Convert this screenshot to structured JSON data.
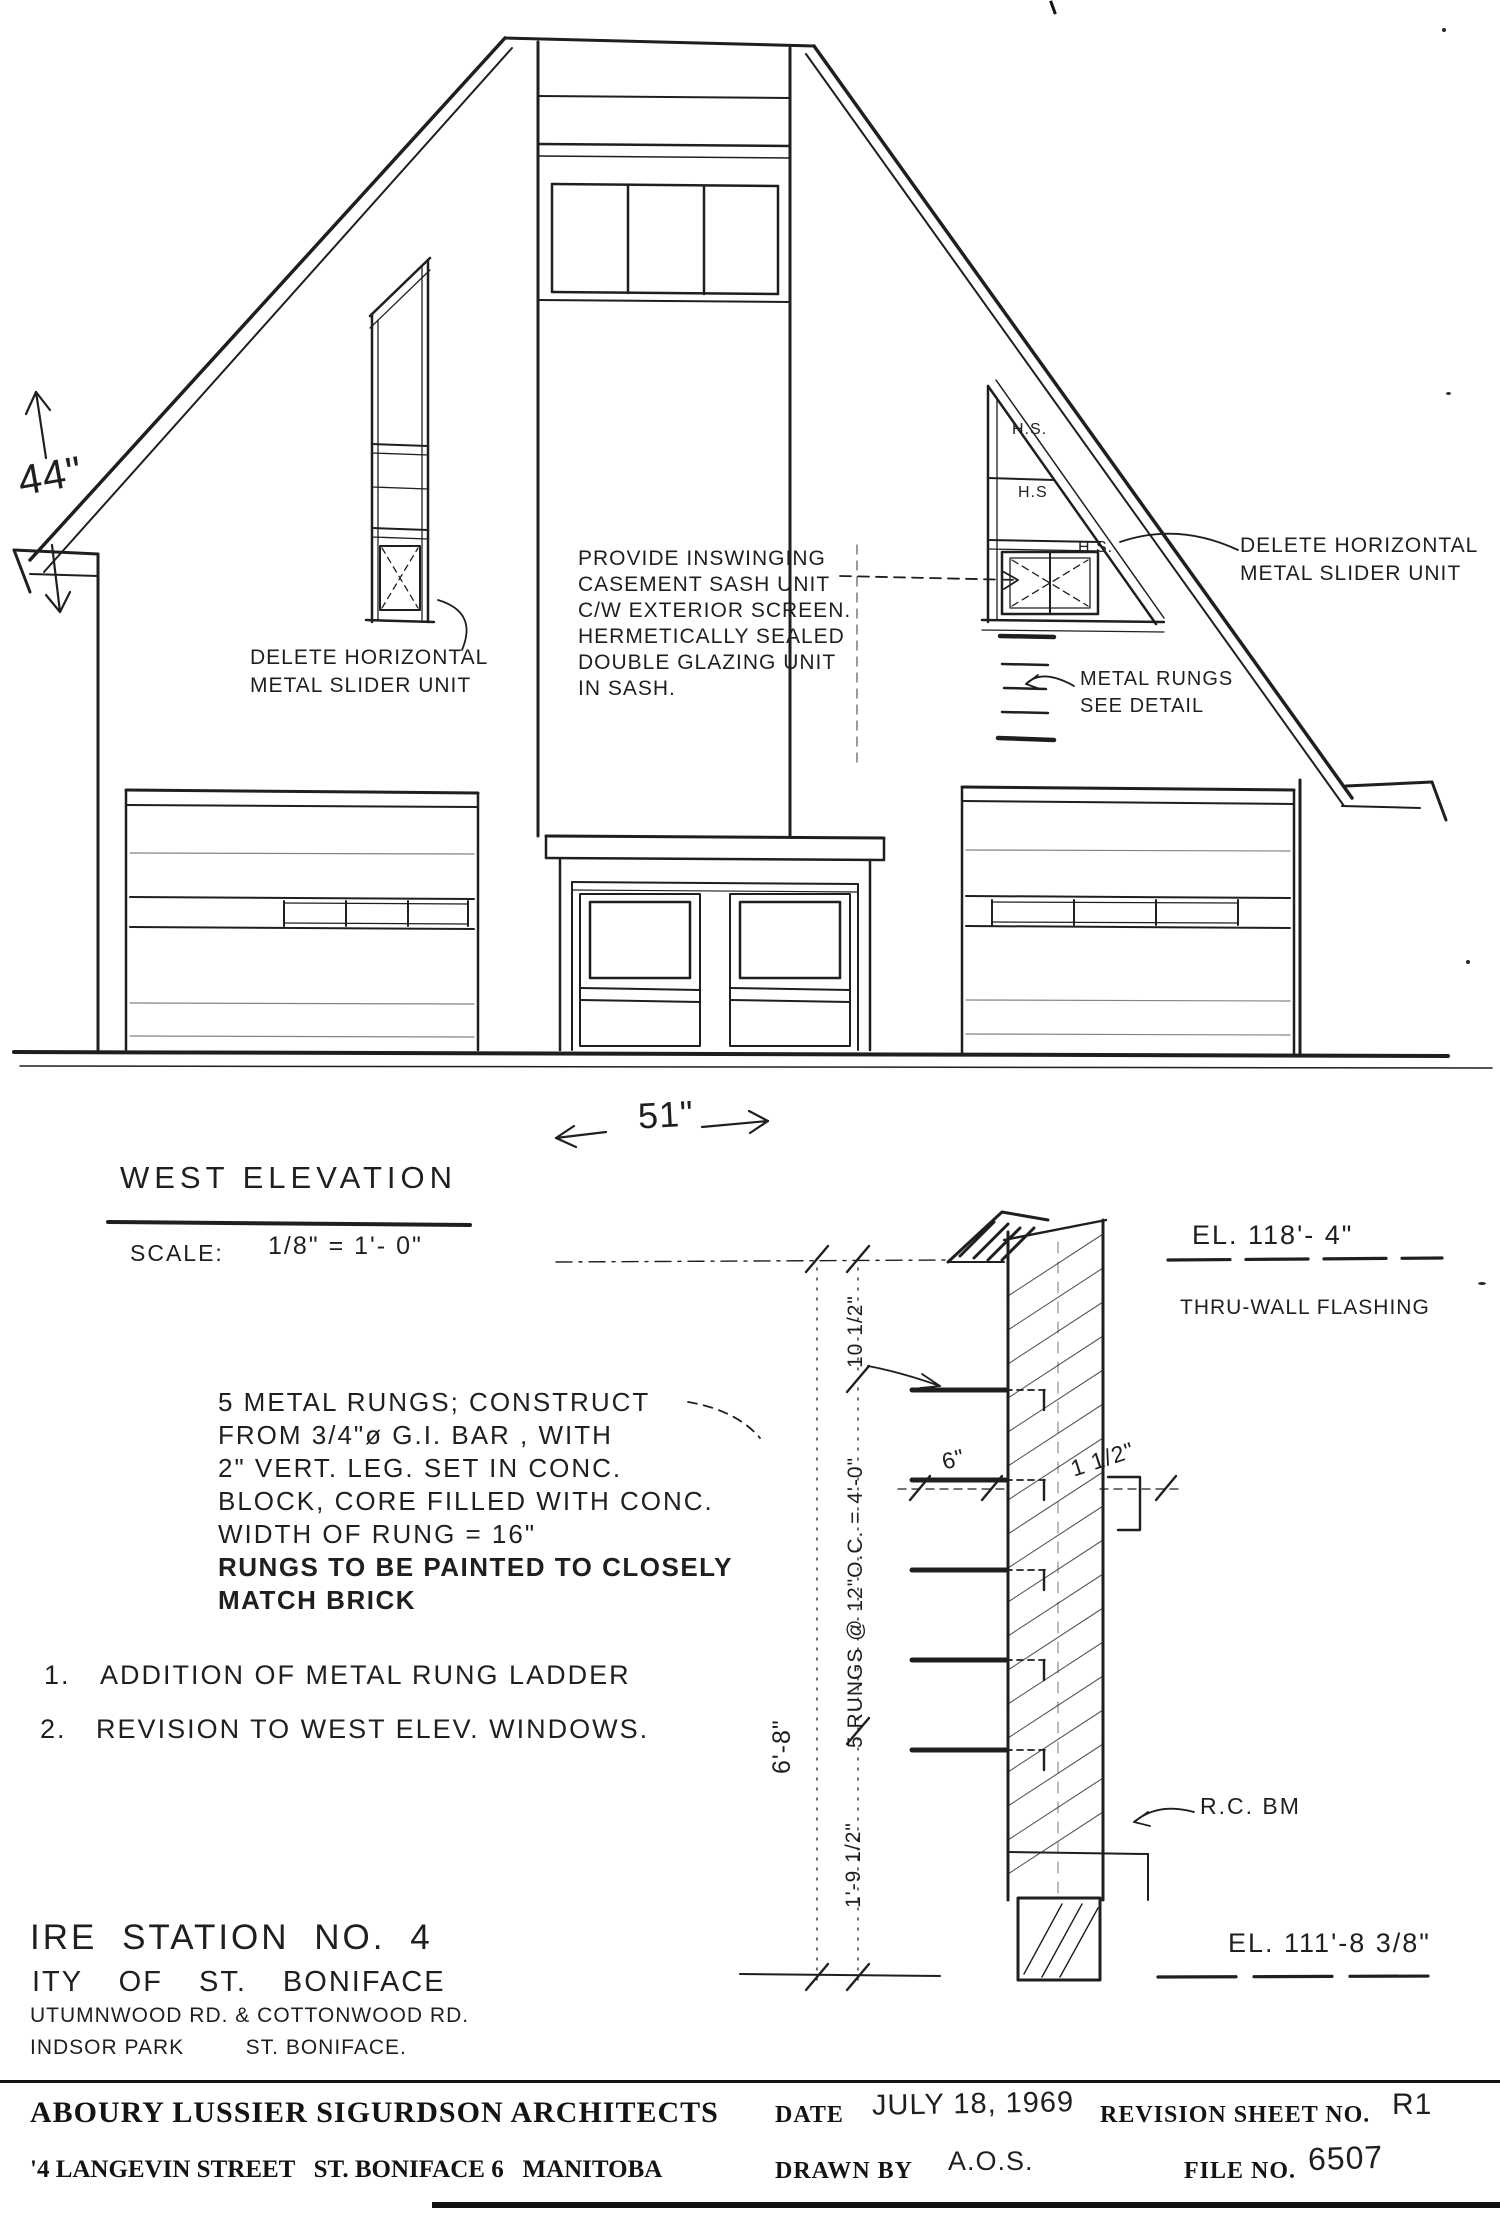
{
  "elevation": {
    "dim_height": "44\"",
    "dim_width": "51\"",
    "casement_note": {
      "l1": "PROVIDE INSWINGING",
      "l2": "CASEMENT SASH UNIT",
      "l3": "C/W EXTERIOR SCREEN.",
      "l4": "HERMETICALLY SEALED",
      "l5": "DOUBLE GLAZING UNIT",
      "l6": "IN SASH."
    },
    "delete_note_left": {
      "l1": "DELETE HORIZONTAL",
      "l2": "METAL SLIDER UNIT"
    },
    "delete_note_right": {
      "l1": "DELETE HORIZONTAL",
      "l2": "METAL SLIDER UNIT"
    },
    "rungs_note": {
      "l1": "METAL RUNGS",
      "l2": "SEE DETAIL"
    },
    "hs1": "H.S.",
    "hs2": "H.S",
    "hs3": "H.S.",
    "title": "WEST ELEVATION",
    "scale_label": "SCALE:",
    "scale_value": "1/8\" = 1'- 0\""
  },
  "notes": {
    "rung_spec": {
      "l1": "5 METAL RUNGS; CONSTRUCT",
      "l2": "FROM 3/4\"ø G.I. BAR , WITH",
      "l3": "2\" VERT. LEG. SET IN CONC.",
      "l4": "BLOCK, CORE FILLED WITH CONC.",
      "l5": "WIDTH OF RUNG = 16\"",
      "l6": "RUNGS TO BE PAINTED TO CLOSELY",
      "l7": "MATCH BRICK"
    },
    "rev1_num": "1.",
    "rev1_text": "ADDITION OF METAL RUNG LADDER",
    "rev2_num": "2.",
    "rev2_text": "REVISION TO WEST ELEV. WINDOWS."
  },
  "detail": {
    "el_top": "EL. 118'- 4\"",
    "flashing_label": "THRU-WALL FLASHING",
    "dim_top": "10 1/2\"",
    "dim_rungs": "5 RUNGS @ 12\"O.C. = 4'-0\"",
    "dim_offset": "6\"",
    "dim_leg": "1 1/2\"",
    "dim_total": "6'-8\"",
    "dim_bottom": "1'-9 1/2\"",
    "beam_label": "R.C. BM",
    "el_bottom": "EL. 111'-8 3/8\""
  },
  "project": {
    "line1": "IRE STATION NO. 4",
    "line2": "ITY OF ST. BONIFACE",
    "line3": "UTUMNWOOD RD. & COTTONWOOD RD.",
    "line4": "INDSOR PARK         ST. BONIFACE."
  },
  "titleblock": {
    "firm": "ABOURY LUSSIER SIGURDSON ARCHITECTS",
    "address": "'4 LANGEVIN STREET   ST. BONIFACE 6   MANITOBA",
    "date_label": "DATE",
    "date_value": "JULY 18, 1969",
    "revision_label": "REVISION SHEET NO.",
    "revision_value": "R1",
    "drawn_label": "DRAWN BY",
    "drawn_value": "A.O.S.",
    "file_label": "FILE NO.",
    "file_value": "6507"
  }
}
